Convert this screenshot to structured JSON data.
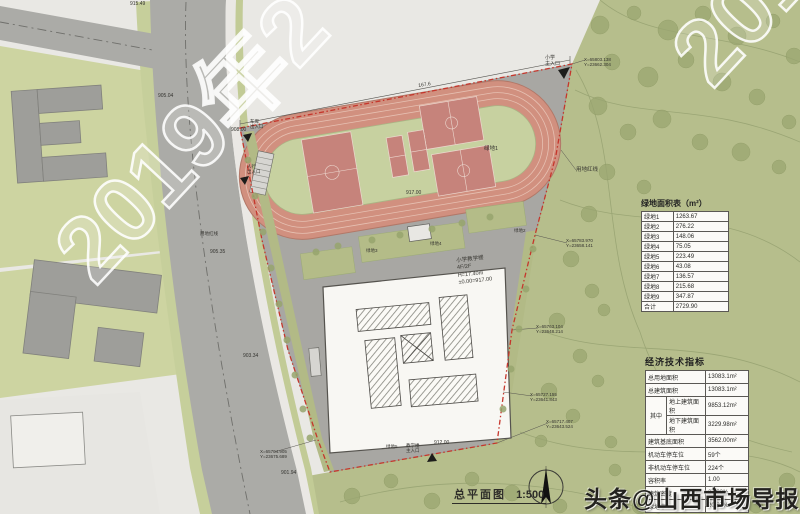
{
  "drawing": {
    "title": "总平面图",
    "scale": "1:500"
  },
  "watermarks": {
    "diagonal": "2019年2",
    "branding": "头条@山西市场导报"
  },
  "building_label": {
    "line1": "小学教学楼",
    "line2": "4F/2F",
    "line3": "H=17.40m",
    "line4": "±0.00=917.00"
  },
  "green_table": {
    "title": "绿地面积表（m²）",
    "rows": [
      [
        "绿地1",
        "1263.67"
      ],
      [
        "绿地2",
        "276.22"
      ],
      [
        "绿地3",
        "148.06"
      ],
      [
        "绿地4",
        "75.05"
      ],
      [
        "绿地5",
        "223.49"
      ],
      [
        "绿地6",
        "43.08"
      ],
      [
        "绿地7",
        "136.57"
      ],
      [
        "绿地8",
        "215.68"
      ],
      [
        "绿地9",
        "347.87"
      ],
      [
        "合计",
        "2729.90"
      ]
    ]
  },
  "econ_table": {
    "title": "经济技术指标",
    "rows": [
      {
        "label": "总用地面积",
        "value": "13083.1m²"
      },
      {
        "label": "总建筑面积",
        "value": "13083.1m²"
      },
      {
        "group": "其中",
        "label": "地上建筑面积",
        "value": "9853.12m²"
      },
      {
        "ingroup": true,
        "label": "地下建筑面积",
        "value": "3229.98m²"
      },
      {
        "label": "建筑基底面积",
        "value": "3562.00m²"
      },
      {
        "label": "机动车停车位",
        "value": "59个"
      },
      {
        "label": "非机动车停车位",
        "value": "224个"
      },
      {
        "label": "容积率",
        "value": "1.00"
      },
      {
        "label": "建筑密度",
        "value": "27.23%"
      },
      {
        "label": "绿地率",
        "value": "20.87%"
      }
    ]
  },
  "annotations": [
    {
      "text": "915.49",
      "x": 130,
      "y": 2,
      "size": 5
    },
    {
      "text": "905.04",
      "x": 158,
      "y": 94,
      "size": 5
    },
    {
      "text": "908.00",
      "x": 231,
      "y": 128,
      "size": 5
    },
    {
      "text": "905.35",
      "x": 210,
      "y": 250,
      "size": 5
    },
    {
      "text": "903.34",
      "x": 243,
      "y": 354,
      "size": 5
    },
    {
      "text": "901.94",
      "x": 281,
      "y": 471,
      "size": 5
    },
    {
      "lines": [
        "X=65704.905",
        "Y=23675.689"
      ],
      "x": 260,
      "y": 449,
      "size": 4.5
    },
    {
      "lines": [
        "X=65803.138",
        "Y=23662.304"
      ],
      "x": 584,
      "y": 57,
      "size": 4.5
    },
    {
      "lines": [
        "X=65783.970",
        "Y=23658.141"
      ],
      "x": 566,
      "y": 238,
      "size": 4.5
    },
    {
      "lines": [
        "X=65763.104",
        "Y=23648.214"
      ],
      "x": 536,
      "y": 324,
      "size": 4.5
    },
    {
      "lines": [
        "X=65727.155",
        "Y=23641.843"
      ],
      "x": 530,
      "y": 392,
      "size": 4.5
    },
    {
      "lines": [
        "X=65717.407",
        "Y=23643.524"
      ],
      "x": 546,
      "y": 419,
      "size": 4.5
    },
    {
      "text": "用地红线",
      "x": 576,
      "y": 167,
      "size": 5.5
    },
    {
      "text": "用地红线",
      "x": 200,
      "y": 231,
      "size": 4.5
    },
    {
      "lines": [
        "小学",
        "主入口"
      ],
      "x": 545,
      "y": 56,
      "size": 5
    },
    {
      "lines": [
        "车库",
        "出入口"
      ],
      "x": 250,
      "y": 119,
      "size": 4.5
    },
    {
      "lines": [
        "人行",
        "出入口"
      ],
      "x": 247,
      "y": 164,
      "size": 4.5
    },
    {
      "lines": [
        "教学楼",
        "主入口"
      ],
      "x": 406,
      "y": 443,
      "size": 4.5
    },
    {
      "text": "绿地1",
      "x": 484,
      "y": 146,
      "size": 5.5
    },
    {
      "text": "绿地2",
      "x": 514,
      "y": 228,
      "size": 4.5
    },
    {
      "text": "绿地3",
      "x": 366,
      "y": 248,
      "size": 4.5
    },
    {
      "text": "绿地4",
      "x": 430,
      "y": 241,
      "size": 4.5
    },
    {
      "text": "绿地5",
      "x": 386,
      "y": 444,
      "size": 4.5
    },
    {
      "text": "917.00",
      "x": 406,
      "y": 191,
      "size": 5
    },
    {
      "text": "912.00",
      "x": 434,
      "y": 441,
      "size": 5
    },
    {
      "text": "167.6",
      "x": 418,
      "y": 84,
      "size": 5,
      "rot": -9
    }
  ]
}
